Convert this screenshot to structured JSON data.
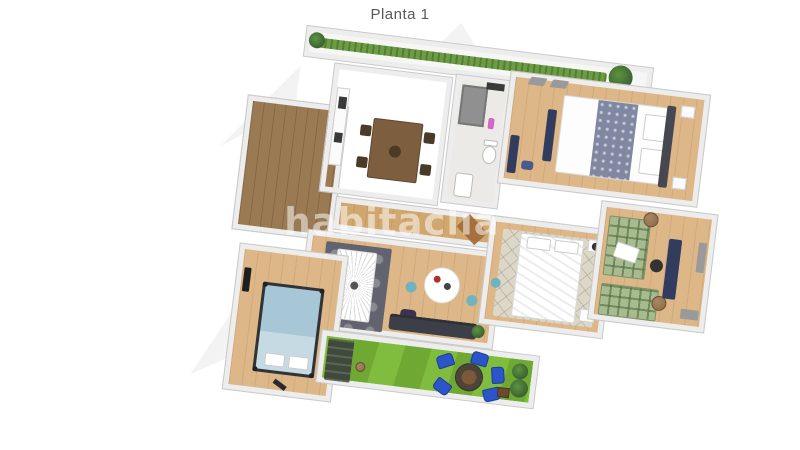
{
  "header": {
    "title": "Planta 1"
  },
  "watermark": {
    "text": "habitaclia"
  },
  "palette": {
    "title_gray": "#58595b",
    "wall_fill": "#ededed",
    "wall_edge": "#c9c9c9",
    "wood_light": "#ddb787",
    "wood_mid": "#d0a76e",
    "wood_dark": "#9a7a52",
    "floor_gray": "#b6b1a9",
    "grass": "#80bd3e",
    "grass_dark": "#6fa934",
    "hedge": "#6d9c44",
    "chair_blue": "#2b55c8",
    "bed_blue": "#a7c6d6",
    "plaid_green": "#a8bb90",
    "rug_dark": "#63636f",
    "rug_beige": "#d8cdb6",
    "navy": "#323c5e",
    "bath_gray": "#909090",
    "accent_orange": "#c96a3e",
    "teal": "#6fb3be",
    "teddy": "#8a6a4a"
  }
}
